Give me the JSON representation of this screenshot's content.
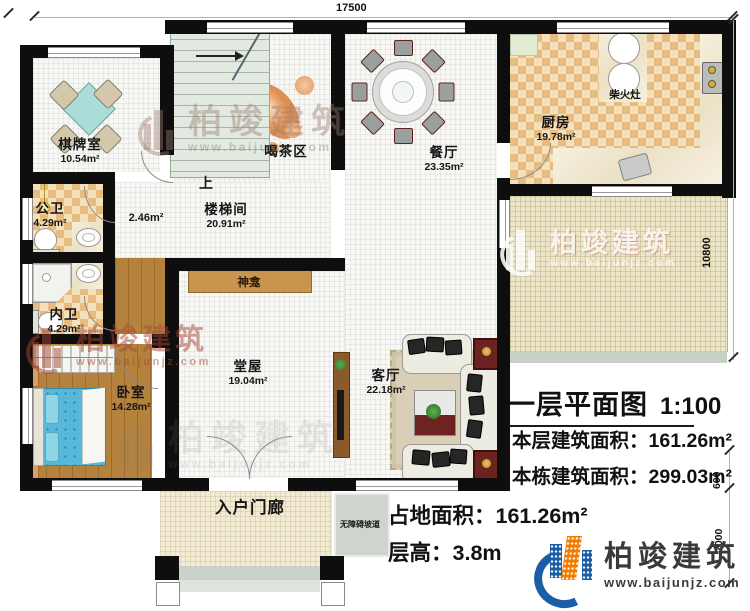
{
  "plan": {
    "dimensions": {
      "top_width": "17500",
      "right_height": "10800",
      "step_depth": "600",
      "porch_depth": "2000"
    },
    "rooms": {
      "qipaishi": {
        "name": "棋牌室",
        "area": "10.54m²"
      },
      "gongwei": {
        "name": "公卫",
        "area": "4.29m²"
      },
      "neiwei": {
        "name": "内卫",
        "area": "4.29m²"
      },
      "woshi": {
        "name": "卧室",
        "area": "14.28m²"
      },
      "loutijian": {
        "name": "楼梯间",
        "area": "20.91m²"
      },
      "corridor": {
        "area": "2.46m²"
      },
      "hechaqu": {
        "name": "喝茶区"
      },
      "canting": {
        "name": "餐厅",
        "area": "23.35m²"
      },
      "chufang": {
        "name": "厨房",
        "area": "19.78m²"
      },
      "tangwu": {
        "name": "堂屋",
        "area": "19.04m²"
      },
      "keting": {
        "name": "客厅",
        "area": "22.18m²"
      },
      "porch": {
        "name": "入户门廊"
      },
      "ramp": {
        "name": "无障碍坡道"
      }
    },
    "annotations": {
      "up": "上",
      "shrine": "神龛",
      "firewood_stove": "柴火灶"
    }
  },
  "title_block": {
    "title": "一层平面图",
    "scale": "1:100",
    "floor_area_label": "本层建筑面积：",
    "floor_area_value": "161.26m²",
    "building_area_label": "本栋建筑面积：",
    "building_area_value": "299.03m²",
    "land_area_label": "占地面积：",
    "land_area_value": "161.26m²",
    "storey_height_label": "层高：",
    "storey_height_value": "3.8m"
  },
  "logo": {
    "brand": "柏竣建筑",
    "website": "www.baijunjz.com"
  },
  "watermark": {
    "brand": "柏竣建筑",
    "website": "www.baijunjz.com"
  },
  "colors": {
    "wall": "#0e0e0e",
    "tile_checker_dark": "#e7bc80",
    "tile_checker_light": "#f4e0ba",
    "wood_floor": "#b5823d",
    "terrace": "#ebe5c9",
    "stairs": "#e1e9e1",
    "logo_blue": "#1b5ea6",
    "logo_orange": "#f07c00",
    "accent_dark_red": "#6d2420",
    "bed_blue": "#57b8da"
  }
}
